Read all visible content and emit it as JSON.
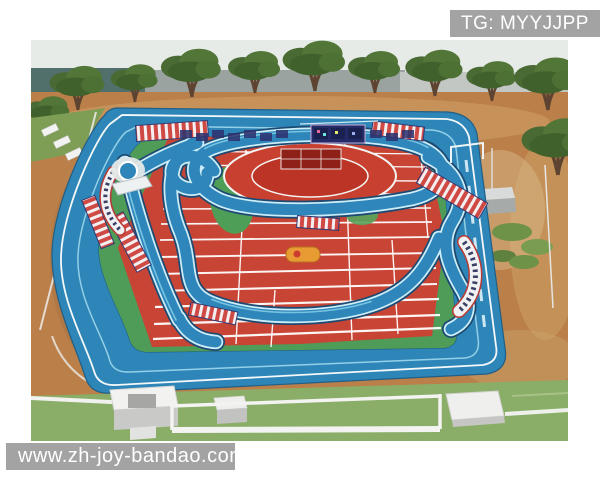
{
  "photo": {
    "description": "Aerial cartoon-style view of a playground: a red athletics field with white lane lines and winding blue water channels crossed by red-and-white footbridges, enclosed by a wide blue rounded running ring; trees and bare tan dirt behind, green lawn with white paths and small white buildings in front"
  },
  "watermarks": {
    "top_right": {
      "text": "TG: MYYJJPP"
    },
    "bottom_left": {
      "text": "www.zh-joy-bandao.com"
    }
  },
  "colors": {
    "track_red": "#c84434",
    "ring_blue": "#2e85b8",
    "channel_outline": "#1c4a72",
    "infield_green": "#4f9b58",
    "lawn_green": "#8aae68",
    "dirt_tan": "#bb7f49",
    "tree_green": "#4a6a33",
    "sky": "#e7ebe7",
    "line_white": "#ffffff",
    "watermark_bg": "#9e9e9e",
    "watermark_text": "#ffffff"
  }
}
